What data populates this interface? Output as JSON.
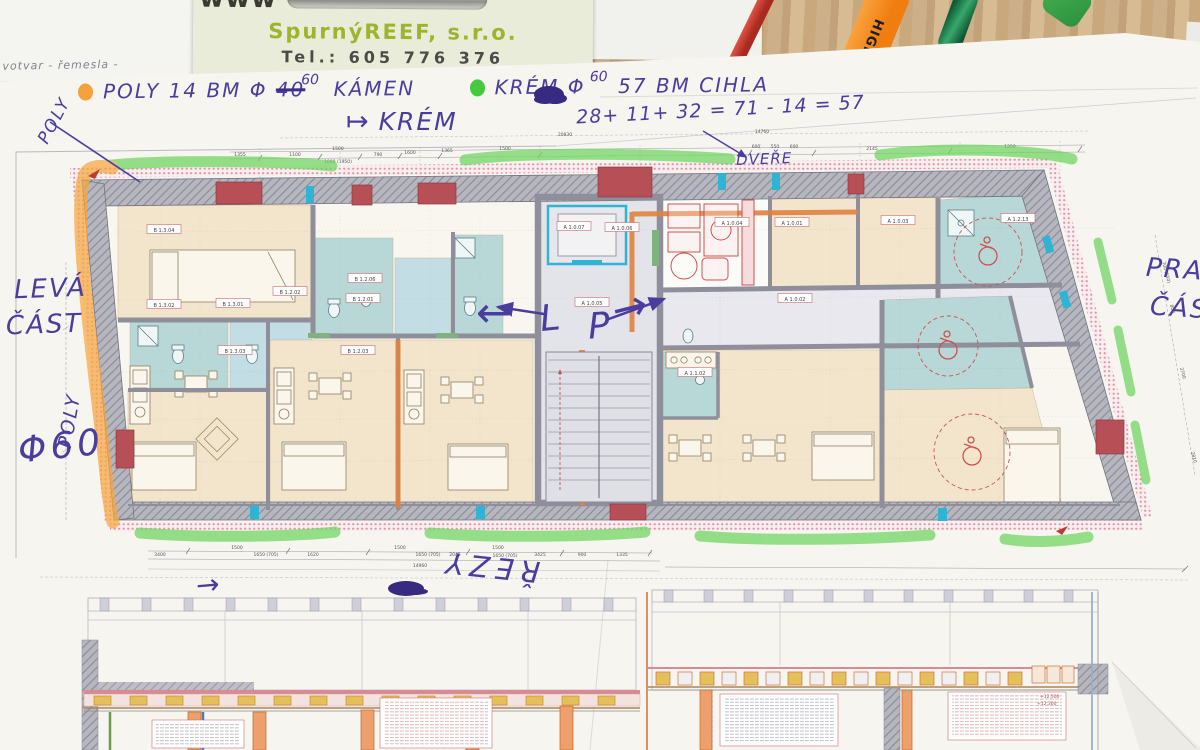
{
  "scene": {
    "underlying_paper_text": "votvar - řemesla -"
  },
  "business_card": {
    "logo_text": "www",
    "company": "SpurnýREEF, s.r.o.",
    "phone": "Tel.: 605 776 376"
  },
  "pens": {
    "highlighter_text": "HIGH"
  },
  "handwriting": {
    "note1_pre": "POLY 14 BM Φ",
    "note1_struck": "40",
    "note1_sup": "60",
    "note1_post": "KÁMEN",
    "note2_pre": "KRÉM Φ",
    "note2_sup": "60",
    "note2_post": "57 BM CIHLA",
    "krem_arrow": "↦",
    "krem_label": "KRÉM",
    "calc": "28+ 11+ 32 = 71 - 14 = 57",
    "dvere": "DVEŘE",
    "poly_top": "POLY",
    "leva_line1": "LEVÁ",
    "leva_line2": "ČÁST",
    "poly_side": "POLY",
    "phi60": "Φ60",
    "prava_line1": "PRAVÁ",
    "prava_line2": "ČÁST",
    "lp_left_arrow": "←",
    "lp_l": "L",
    "lp_p": "P",
    "lp_right_arrow": "→",
    "rezy": "ŘEZY",
    "rezy_arrow": "→"
  },
  "plan": {
    "rooms": [
      {
        "label": "B 1.3.04"
      },
      {
        "label": "B 1.3.02"
      },
      {
        "label": "B 1.3.01"
      },
      {
        "label": "B 1.3.03"
      },
      {
        "label": "B 1.2.06"
      },
      {
        "label": "B 1.2.02"
      },
      {
        "label": "B 1.2.01"
      },
      {
        "label": "B 1.2.03"
      },
      {
        "label": "A 1.0.07"
      },
      {
        "label": "A 1.0.06"
      },
      {
        "label": "A 1.0.05"
      },
      {
        "label": "A 1.0.04"
      },
      {
        "label": "A 1.0.01"
      },
      {
        "label": "A 1.0.03"
      },
      {
        "label": "A 1.0.02"
      },
      {
        "label": "A 1.1.02"
      },
      {
        "label": "A 1.2.13"
      }
    ],
    "top_dims": [
      "1355",
      "1100",
      "1500",
      "1000 (1950)",
      "790",
      "1600",
      "1365",
      "1500",
      "600",
      "550",
      "600",
      "2145",
      "1250",
      "20830",
      "14760"
    ],
    "bottom_dims": [
      "3400",
      "1500",
      "1650 (705)",
      "1620",
      "1500",
      "1650 (705)",
      "2045",
      "1500",
      "1650 (705)",
      "3425",
      "900",
      "1335",
      "14960"
    ],
    "right_dims": [
      "700 (550)",
      "800",
      "2700",
      "2810"
    ],
    "levels": [
      "+12,500",
      "+12,300"
    ]
  },
  "colors": {
    "ink": "#4a3d9e",
    "green_highlighter": "#6fd55f",
    "orange_highlighter": "#f6a73f",
    "wall_gray": "#9d9da8",
    "red_masonry": "#b65056",
    "room_beige": "#f2e5cb",
    "room_teal": "#b7d8d6",
    "room_blue": "#c2dde4",
    "fixture_cyan": "#2fb4d4",
    "heating_orange": "#e0823f"
  }
}
